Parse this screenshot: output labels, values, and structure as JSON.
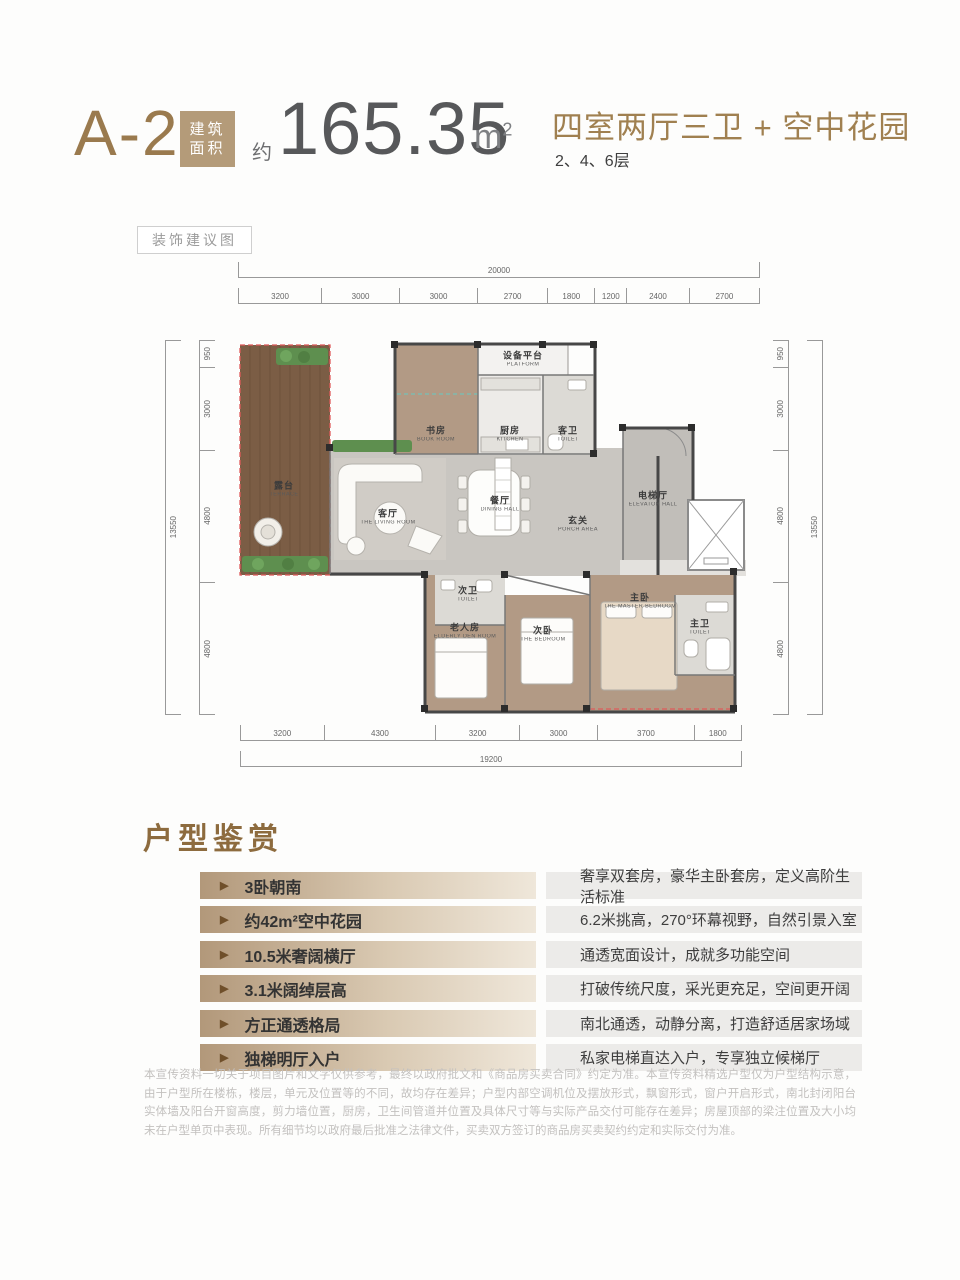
{
  "header": {
    "unit_code": "A-2",
    "area_tag_line1": "建筑",
    "area_tag_line2": "面积",
    "area_prefix": "约",
    "area_value": "165.35",
    "area_unit_base": "m",
    "area_unit_sup": "2",
    "layout_title": "四室两厅三卫 + 空中花园",
    "floors": "2、4、6层"
  },
  "plan": {
    "decor_tag": "装饰建议图",
    "dims": {
      "top_total": "20000",
      "top_segments": [
        "3200",
        "3000",
        "3000",
        "2700",
        "1800",
        "1200",
        "2400",
        "2700"
      ],
      "bottom_total": "19200",
      "bottom_segments": [
        "3200",
        "4300",
        "3200",
        "3000",
        "3700",
        "1800"
      ],
      "left_total": "13550",
      "left_segments": [
        "950",
        "3000",
        "4800",
        "4800"
      ],
      "right_total": "13550",
      "right_segments": [
        "950",
        "3000",
        "4800",
        "4800"
      ]
    },
    "rooms": {
      "terrace": {
        "cn": "露台",
        "en": "TERRACE"
      },
      "study": {
        "cn": "书房",
        "en": "BOOK ROOM"
      },
      "platform": {
        "cn": "设备平台",
        "en": "PLATFORM"
      },
      "kitchen": {
        "cn": "厨房",
        "en": "KITCHEN"
      },
      "guest_toilet": {
        "cn": "客卫",
        "en": "TOILET"
      },
      "living": {
        "cn": "客厅",
        "en": "THE LIVING ROOM"
      },
      "dining": {
        "cn": "餐厅",
        "en": "DINING HALL"
      },
      "porch": {
        "cn": "玄关",
        "en": "PORCH AREA"
      },
      "elevator_hall": {
        "cn": "电梯厅",
        "en": "ELEVATOR HALL"
      },
      "second_toilet": {
        "cn": "次卫",
        "en": "TOILET"
      },
      "elderly_room": {
        "cn": "老人房",
        "en": "ELDERLY DEN ROOM"
      },
      "second_bedroom": {
        "cn": "次卧",
        "en": "THE BEDROOM"
      },
      "master_bedroom": {
        "cn": "主卧",
        "en": "THE MASTER BEDROOM"
      },
      "master_toilet": {
        "cn": "主卫",
        "en": "TOILET"
      }
    }
  },
  "features": {
    "title": "户型鉴赏",
    "items": [
      {
        "label": "3卧朝南",
        "desc": "奢享双套房，豪华主卧套房，定义高阶生活标准"
      },
      {
        "label": "约42m²空中花园",
        "desc": "6.2米挑高，270°环幕视野，自然引景入室"
      },
      {
        "label": "10.5米奢阔横厅",
        "desc": "通透宽面设计，成就多功能空间"
      },
      {
        "label": "3.1米阔绰层高",
        "desc": "打破传统尺度，采光更充足，空间更开阔"
      },
      {
        "label": "方正通透格局",
        "desc": "南北通透，动静分离，打造舒适居家场域"
      },
      {
        "label": "独梯明厅入户",
        "desc": "私家电梯直达入户，专享独立候梯厅"
      }
    ]
  },
  "disclaimer": "本宣传资料一切关于项目图片和文字仅供参考，最终以政府批文和《商品房买卖合同》约定为准。本宣传资料精选户型仅为户型结构示意，由于户型所在楼栋，楼层，单元及位置等的不同，故均存在差异；户型内部空调机位及摆放形式，飘窗形式，窗户开启形式，南北封闭阳台实体墙及阳台开窗高度，剪力墙位置，厨房，卫生间管道并位置及具体尺寸等与实际产品交付可能存在差异；房屋顶部的梁注位置及大小均未在户型单页中表现。所有细节均以政府最后批准之法律文件，买卖双方签订的商品房买卖契约约定和实际交付为准。",
  "colors": {
    "accent_gold": "#9a7a4e",
    "tag_bg": "#b49b79",
    "number_gray": "#57585a",
    "terrace_wood": "#7b5d45",
    "room_wood": "#b29a85",
    "floor_gray": "#c9c6c1",
    "red_dash": "#e05a5a",
    "teal_dash": "#66c9c2",
    "plant_green": "#5e8f4f"
  }
}
